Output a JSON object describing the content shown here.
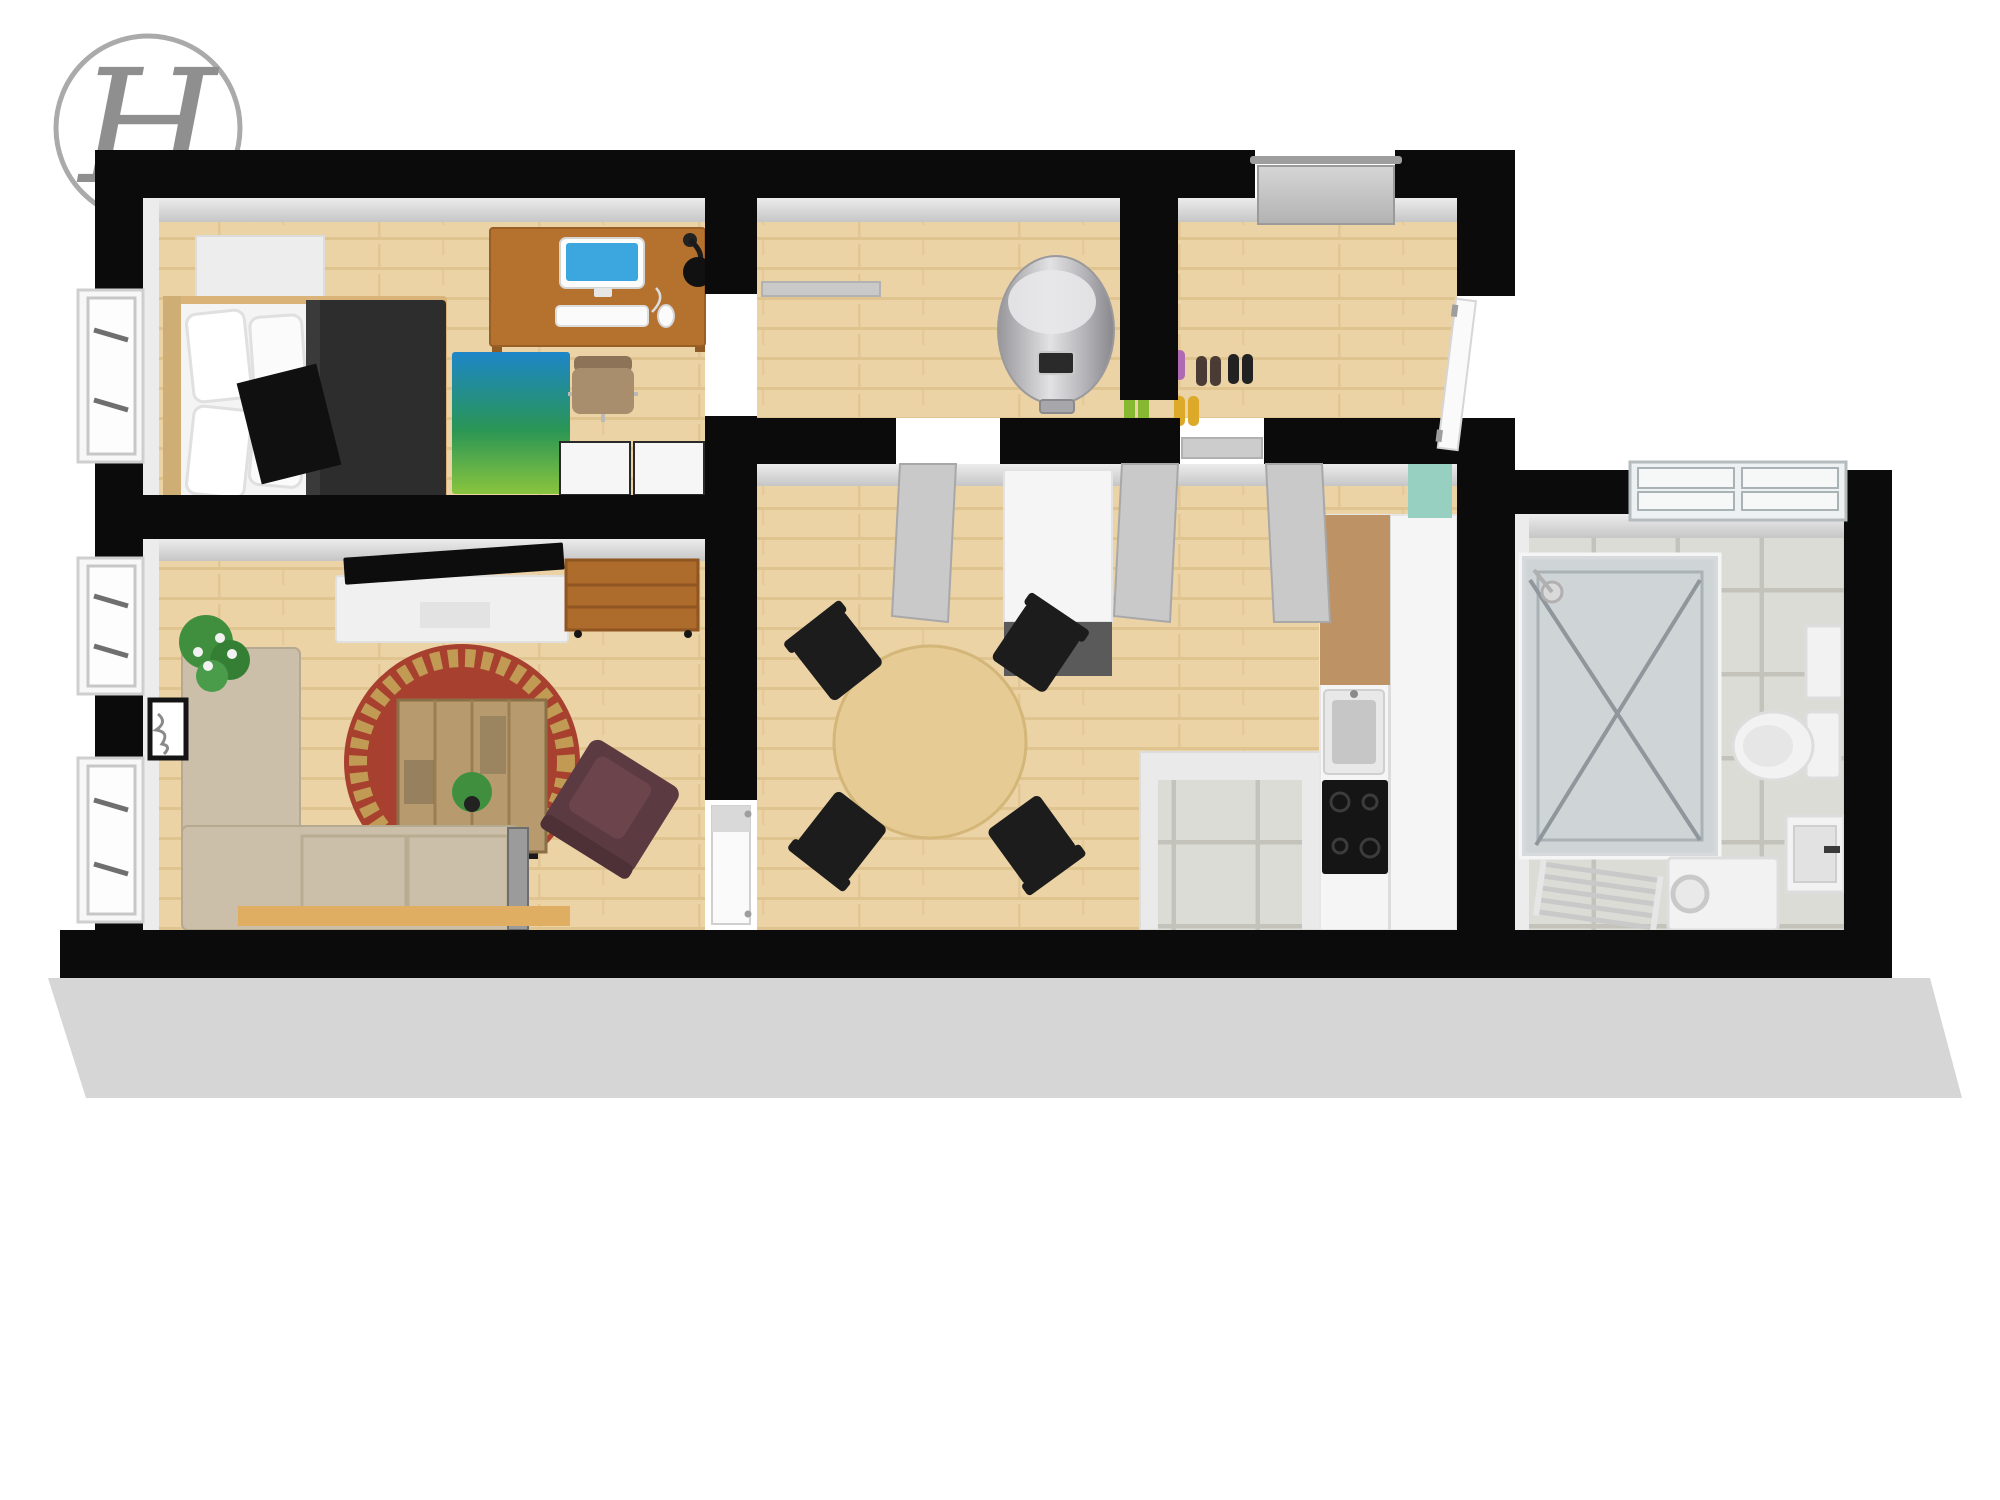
{
  "logo": {
    "letter": "H"
  },
  "scene": {
    "type": "3d-floor-plan",
    "view": "top-down cutaway of a one-bedroom apartment",
    "rooms": [
      {
        "id": "bedroom",
        "position": "top-left",
        "items": [
          "double-bed",
          "white-pillows",
          "dark-duvet",
          "black-accent-pillow",
          "blue-green-rug",
          "wardrobe-box",
          "wooden-desk",
          "desktop-computer",
          "keyboard",
          "mouse",
          "desk-lamp",
          "office-chair",
          "white-dressers",
          "window"
        ]
      },
      {
        "id": "living-room",
        "position": "bottom-left",
        "items": [
          "corner-sofa",
          "sofa-board",
          "coffee-table",
          "table-plant",
          "round-oriental-rug",
          "tv",
          "tv-stand",
          "leather-armchair",
          "wooden-sideboard",
          "potted-plant",
          "wall-art",
          "windows"
        ]
      },
      {
        "id": "hallway",
        "position": "top-middle",
        "items": [
          "water-heater",
          "six-pairs-of-shoes",
          "entrance-door",
          "open-bedroom-door",
          "open-white-door"
        ]
      },
      {
        "id": "kitchen-dining",
        "position": "middle-right",
        "items": [
          "round-dining-table",
          "four-black-chairs",
          "tall-cabinet",
          "kitchen-counter",
          "sink",
          "cooktop",
          "double-doors",
          "mint-glass-panel"
        ]
      },
      {
        "id": "storage-nook",
        "position": "bottom-middle-right",
        "items": [
          "tiled-floor"
        ]
      },
      {
        "id": "bathroom",
        "position": "right",
        "items": [
          "glass-shower-cabin",
          "shower-head",
          "frosted-window",
          "toilet",
          "wall-cabinet",
          "washbasin",
          "washing-machine",
          "drying-rack",
          "tiled-floor"
        ]
      }
    ]
  },
  "colors": {
    "wall": "#0b0b0b",
    "plinth": "#d6d6d6",
    "inner_wall_light": "#ececec",
    "inner_wall_mid": "#c6c6c6",
    "wood_base": "#ecd3a6",
    "wood_line": "#dcc08b",
    "tile_base": "#dcdcd6",
    "tile_grout": "#c3c3bc",
    "rug_blue": "#1d86c8",
    "rug_green": "#2a9655",
    "rug_lime": "#8ac43e",
    "bed_frame": "#d9b377",
    "bedding_white": "#f4f4f4",
    "duvet_dark": "#2d2d2d",
    "pillow_black": "#101010",
    "desk_wood": "#b5712e",
    "screen_blue": "#3ba7de",
    "office_chair_tan": "#a98e6d",
    "living_rug_red": "#a8402f",
    "living_rug_gold": "#c19a53",
    "coffee_table_wood": "#b79b6e",
    "sofa_beige": "#cbbfa9",
    "sofa_board_wood": "#dfae63",
    "armchair_maroon": "#5c3a41",
    "sideboard_wood": "#ad6b2c",
    "tv_black": "#0d0d0d",
    "tv_stand_white": "#f0f0f0",
    "plant_green": "#3f8f3f",
    "flower_white": "#f2f2f2",
    "dining_table_wood": "#e6cb94",
    "chair_black": "#1c1c1c",
    "cabinet_white": "#f5f5f5",
    "cabinet_dark_front": "#5a5a5a",
    "counter_brown": "#bd9365",
    "sink_silver": "#c6c6c6",
    "cooktop_black": "#151515",
    "mint_accent": "#97cfc0",
    "door_gray": "#c9c9c9",
    "door_white": "#fafafa",
    "frame_silver": "#9e9e9e",
    "fixture_white": "#f2f2f2",
    "fixture_shadow": "#dddddd",
    "shoe_green": "#86b832",
    "shoe_purple": "#b06ab3",
    "shoe_yellow": "#dca928",
    "shoe_brown": "#4a3c34",
    "shoe_black": "#222222",
    "logo_gray": "#8f8f8f"
  }
}
